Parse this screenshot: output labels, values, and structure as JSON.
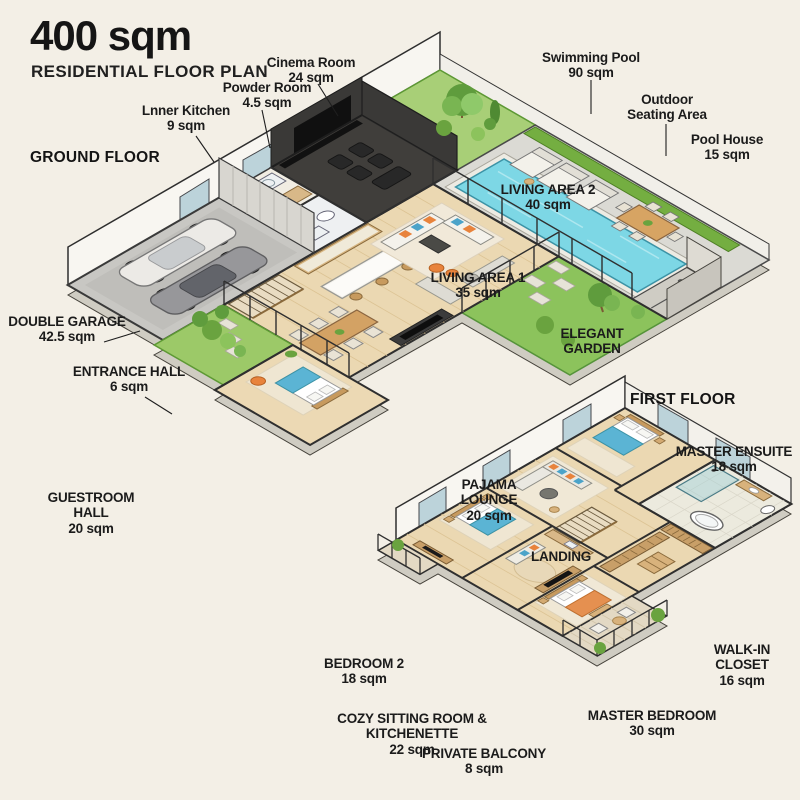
{
  "title": {
    "main": "400 sqm",
    "subtitle": "RESIDENTIAL FLOOR PLAN"
  },
  "floors": {
    "ground": "GROUND FLOOR",
    "first": "FIRST FLOOR"
  },
  "rooms": {
    "inner_kitchen": {
      "name": "Lnner Kitchen",
      "area": "9 sqm"
    },
    "powder_room": {
      "name": "Powder Room",
      "area": "4.5 sqm"
    },
    "cinema_room": {
      "name": "Cinema Room",
      "area": "24 sqm"
    },
    "swimming_pool": {
      "name": "Swimming Pool",
      "area": "90 sqm"
    },
    "outdoor_seating": {
      "name": "Outdoor Seating Area",
      "area": ""
    },
    "pool_house": {
      "name": "Pool House",
      "area": "15 sqm"
    },
    "living_area_2": {
      "name": "LIVING AREA 2",
      "area": "40 sqm"
    },
    "living_area_1": {
      "name": "LIVING AREA 1",
      "area": "35 sqm"
    },
    "elegant_garden": {
      "name": "ELEGANT GARDEN",
      "area": ""
    },
    "double_garage": {
      "name": "DOUBLE GARAGE",
      "area": "42.5 sqm"
    },
    "entrance_hall": {
      "name": "ENTRANCE HALL",
      "area": "6 sqm"
    },
    "guestroom_hall": {
      "name": "GUESTROOM HALL",
      "area": "20 sqm"
    },
    "master_ensuite": {
      "name": "MASTER ENSUITE",
      "area": "18 sqm"
    },
    "pajama_lounge": {
      "name": "PAJAMA LOUNGE",
      "area": "20 sqm"
    },
    "landing": {
      "name": "LANDING",
      "area": ""
    },
    "walk_in_closet": {
      "name": "WALK-IN CLOSET",
      "area": "16 sqm"
    },
    "bedroom_2": {
      "name": "BEDROOM 2",
      "area": "18 sqm"
    },
    "cozy_sitting": {
      "name": "COZY SITTING ROOM & KITCHENETTE",
      "area": "22 sqm"
    },
    "master_bedroom": {
      "name": "MASTER BEDROOM",
      "area": "30 sqm"
    },
    "private_balcony": {
      "name": "PRIVATE BALCONY",
      "area": "8 sqm"
    }
  },
  "colors": {
    "background": "#f3efe6",
    "text": "#1b1b1b",
    "pool_water": "#7dd7e5",
    "lawn": "#8cc35c",
    "hedge": "#74ae41",
    "wood_floor": "#ebd8b2",
    "deck": "#dbdad4",
    "wall": "#f8f6f1",
    "dark_room": "#3f3e3b",
    "accent_orange": "#e8833c",
    "accent_blue": "#4ba3c9"
  }
}
